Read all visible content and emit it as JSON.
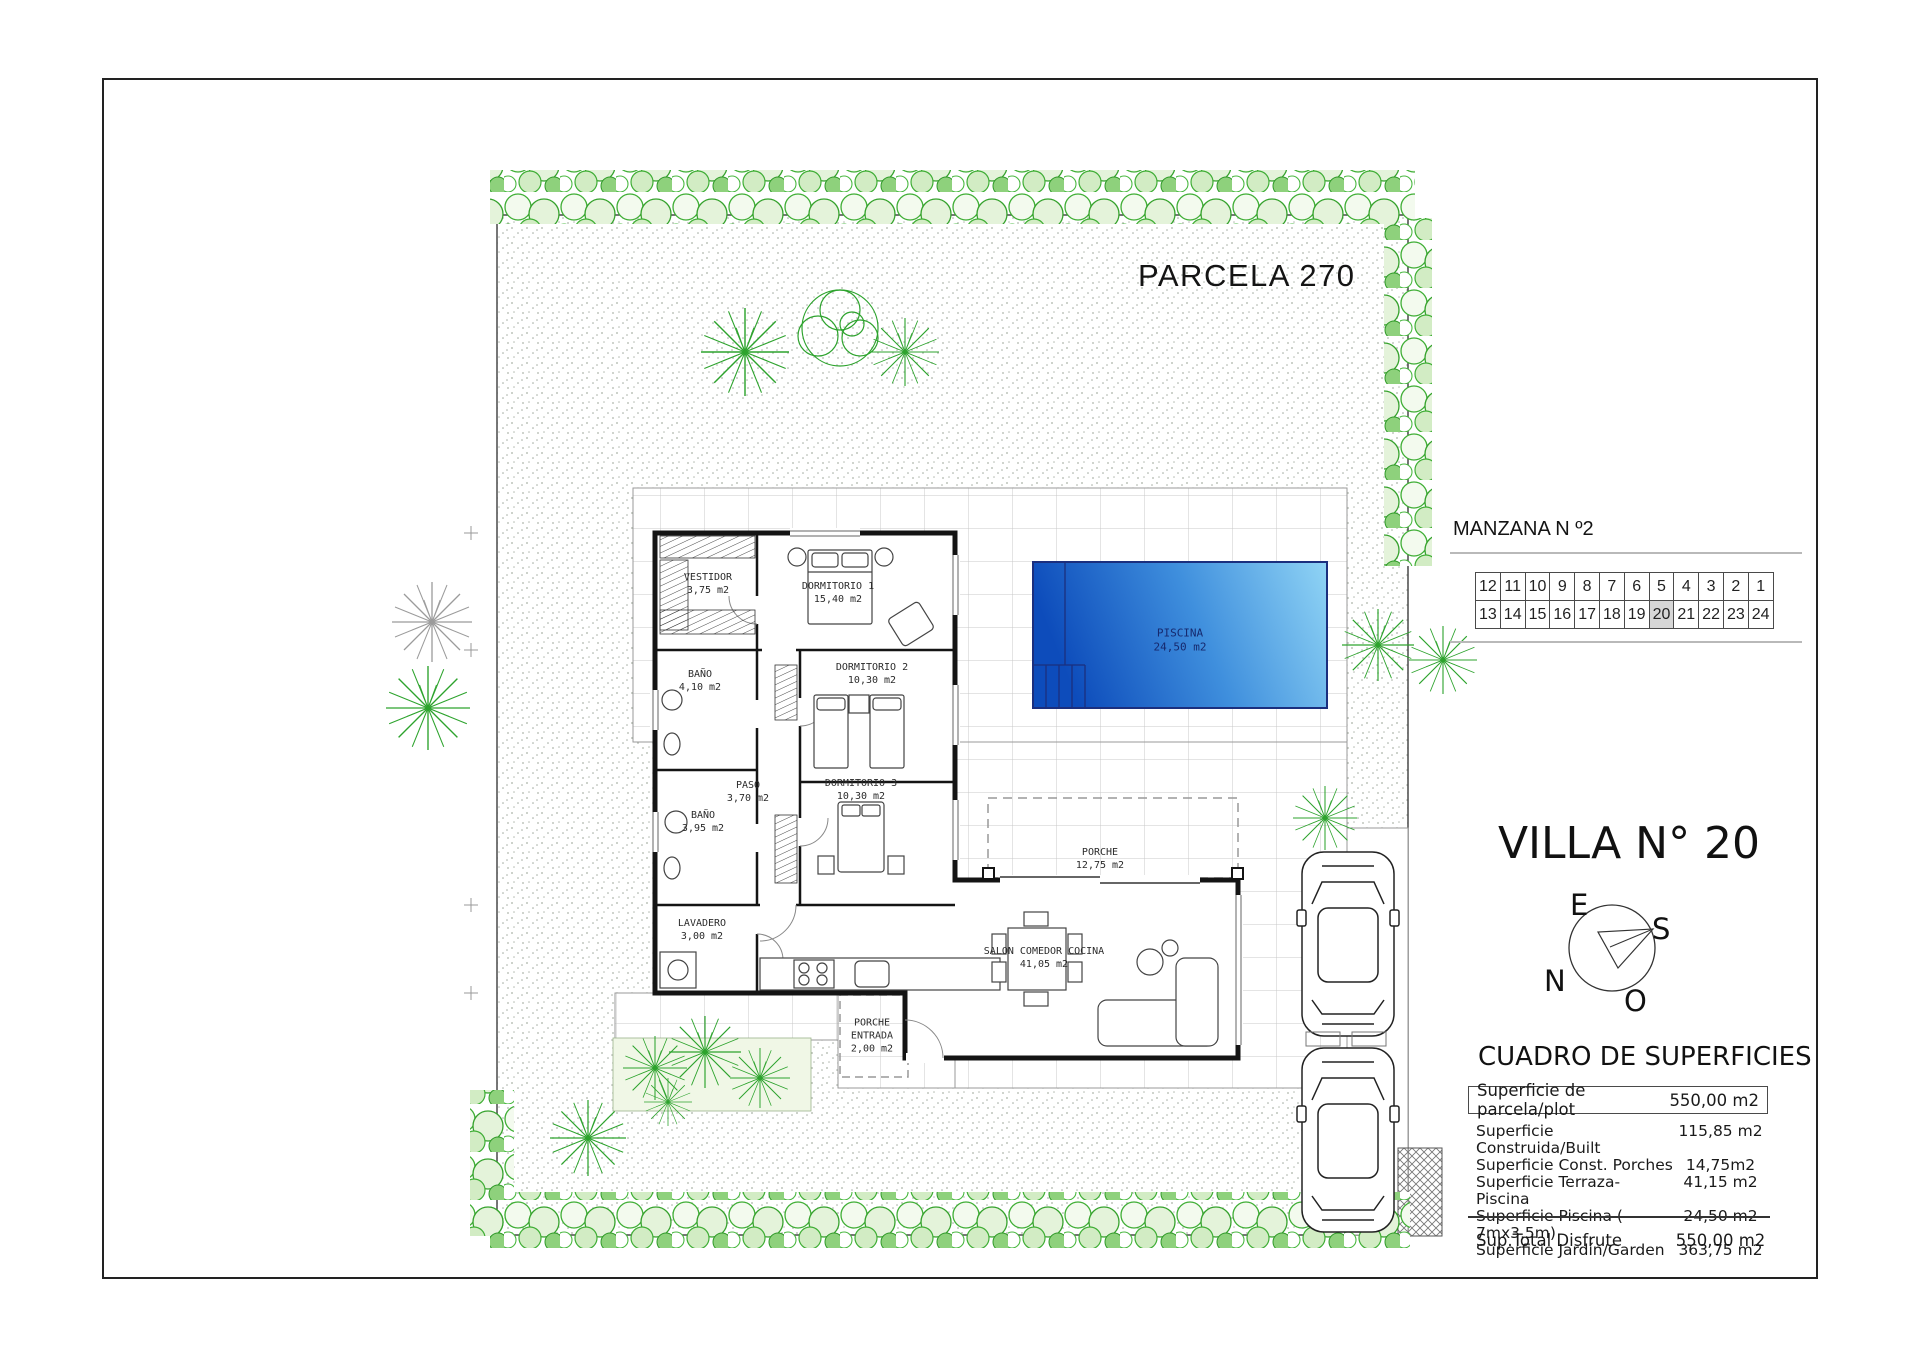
{
  "plan": {
    "parcel_title": "PARCELA 270",
    "rooms": [
      {
        "name": "VESTIDOR",
        "area": "3,75 m2"
      },
      {
        "name": "DORMITORIO 1",
        "area": "15,40 m2"
      },
      {
        "name": "BAÑO",
        "area": "4,10 m2"
      },
      {
        "name": "DORMITORIO 2",
        "area": "10,30 m2"
      },
      {
        "name": "PASO",
        "area": "3,70 m2"
      },
      {
        "name": "DORMITORIO 3",
        "area": "10,30 m2"
      },
      {
        "name": "BAÑO",
        "area": "3,95 m2"
      },
      {
        "name": "LAVADERO",
        "area": "3,00 m2"
      },
      {
        "name": "PORCHE",
        "area": "12,75 m2"
      },
      {
        "name": "SALON COMEDOR COCINA",
        "area": "41,05 m2"
      },
      {
        "name": "PORCHE ENTRADA",
        "area": "2,00 m2"
      },
      {
        "name": "PISCINA",
        "area": "24,50 m2"
      }
    ]
  },
  "manzana": {
    "label": "MANZANA N º2",
    "top_row": [
      "12",
      "11",
      "10",
      "9",
      "8",
      "7",
      "6",
      "5",
      "4",
      "3",
      "2",
      "1"
    ],
    "bottom_row": [
      "13",
      "14",
      "15",
      "16",
      "17",
      "18",
      "19",
      "20",
      "21",
      "22",
      "23",
      "24"
    ],
    "highlighted": "20"
  },
  "villa": {
    "title": "VILLA N° 20"
  },
  "compass": {
    "east": "E",
    "south": "S",
    "north": "N",
    "west": "O"
  },
  "surfaces": {
    "title": "CUADRO DE SUPERFICIES",
    "plot_row": {
      "label": "Superficie de parcela/plot",
      "value": "550,00 m2"
    },
    "rows": [
      {
        "label": "Superficie Construida/Built",
        "value": "115,85 m2"
      },
      {
        "label": "Superficie Const. Porches",
        "value": "14,75m2"
      },
      {
        "label": "Superficie Terraza-Piscina",
        "value": "41,15 m2"
      },
      {
        "label": "Superficie Piscina ( 7mx3,5m)",
        "value": "24,50 m2"
      },
      {
        "label": "Superficie Jardín/Garden",
        "value": "363,75 m2"
      }
    ],
    "total_row": {
      "label": "Sup.Total Disfrute",
      "value": "550,00 m2"
    }
  },
  "colors": {
    "pool_dark": "#0d4cbb",
    "pool_mid": "#3f8fdd",
    "pool_light": "#90d4f5",
    "pool_border": "#1b2f7e",
    "hedge_green": "#3fae35",
    "wall": "#141414",
    "tile_line": "#c9c9c9",
    "highlight_cell": "#d6d6d6"
  }
}
